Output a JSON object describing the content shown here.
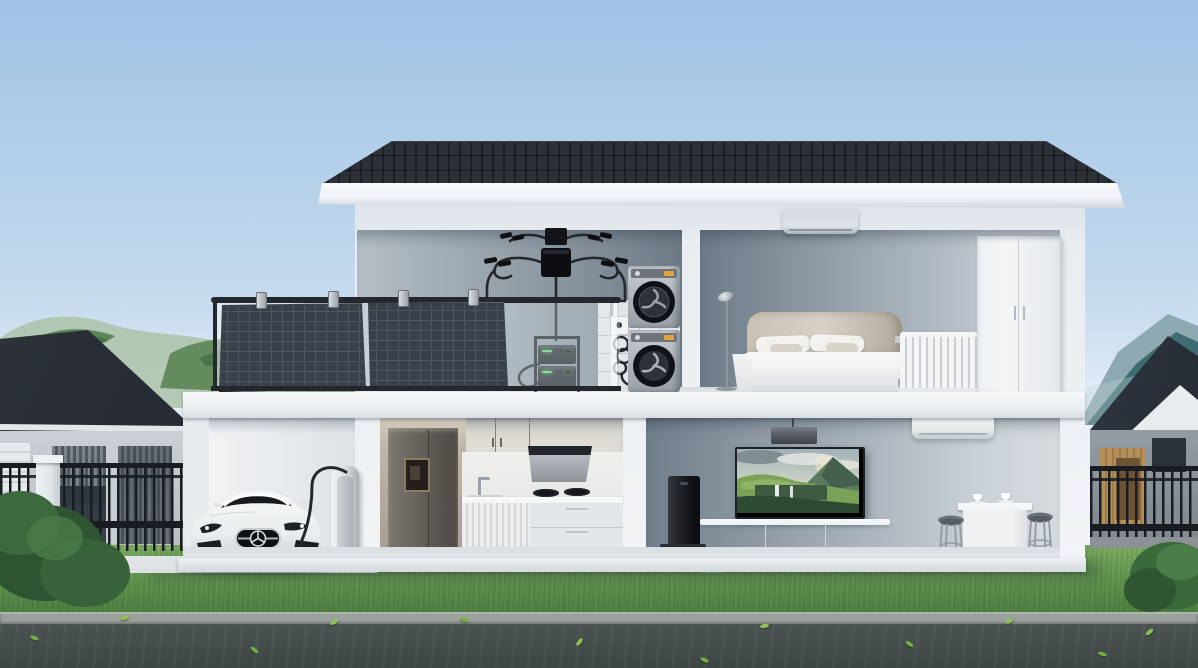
{
  "meta": {
    "type": "3d-architectural-render",
    "description": "Cutaway view of a two-storey smart home with balcony solar panels, micro-inverter, stacked battery storage, EV charging, and smart appliances; neighbouring houses, fences, lawn and road in front, mountains behind",
    "width": 1198,
    "height": 668
  },
  "colors": {
    "sky_top": "#9fc2e4",
    "sky_mid": "#c6dbee",
    "sky_low": "#e7eff7",
    "cloud": "#f6fafc",
    "roof": "#23262d",
    "fascia": "#eef1f5",
    "wall": "#e9edf1",
    "slab": "#edf0f3",
    "plinth": "#eef1f4",
    "laundry_l": "#b6bfc6",
    "laundry_r": "#6e7b87",
    "bed_l": "#6d7b88",
    "bed_r": "#c5cdd4",
    "liv_l": "#707e8b",
    "liv_r": "#cbd2d8",
    "tile": "#eef0f1",
    "floor": "#e1e5e9",
    "panel": "#394049",
    "panel_line": "#4d5560",
    "rail": "#24282d",
    "glass": "rgba(228,238,245,0.30)",
    "inverter": "#121418",
    "cable": "#24272b",
    "washer_hi": "#c6cbd0",
    "washer_lo": "#99a0a7",
    "washer_panel": "#6d747b",
    "door_black": "#0e1115",
    "door_inner": "#2d3237",
    "display_orange": "#e8a23c",
    "batt": "#1e2327",
    "batt_hi": "#3a4147",
    "led": "#5bd36e",
    "fridge": "#615c57",
    "fridge_hi": "#7d7771",
    "cab_upper": "#a8a29a",
    "cab_tall": "#bfb5a8",
    "hood_dark": "#22262a",
    "hood_body": "#b5bbc1",
    "splash": "#e9e9e7",
    "counter": "#f4f5f6",
    "cab_lower": "#e4e7e9",
    "car": "#eaedef",
    "car_shade": "#c2c8cd",
    "car_glass": "#171b20",
    "car_dark": "#1d2126",
    "charger": "#dfe3e6",
    "charger_dark": "#aab1b7",
    "tv_frame": "#1d2126",
    "console": "#eef1f3",
    "soundbar": "#34383d",
    "dock": "#17191d",
    "robot": "#282c31",
    "mat": "#86add0",
    "ac": "#dde2e7",
    "ac2": "#e8eced",
    "pend": "#565c63",
    "table": "#eff1f3",
    "stool": "#6b7379",
    "stool_leg": "#959ca2",
    "lamp": "#8f979e",
    "head": "#c9c1b4",
    "head_dark": "#b2aa9d",
    "pillow": "#f0efec",
    "cushion": "#d9d3c9",
    "duvet": "#f1f2f3",
    "bedbase": "#e9ebee",
    "radiator": "#f3f5f7",
    "rad_shade": "#c9cfd5",
    "wardrobe": "#f3f5f7",
    "ward_seam": "#c4cbd1",
    "lawn": "#649751",
    "lawn_light": "#7cab60",
    "lawn_dark": "#4a7a3e",
    "pad": "#dbdfe1",
    "curb": "#9ba19d",
    "road": "#4a5351",
    "road_dark": "#3d4644",
    "leaf": "#6fae3f",
    "fence": "#191d21",
    "pillar": "#e2e6e9",
    "base_conc": "#8b9194",
    "n_roof": "#272c34",
    "n_wall": "#c9cfd4",
    "n_wall2": "#949ca3",
    "n_win": "#2b323a",
    "slat": "#8d959c",
    "wood": "#b58f58",
    "wood_dark": "#6e5236",
    "hill_far": "#a9c0a5",
    "hill_near": "#55804f",
    "hill_dark": "#3e6a42",
    "mtn_far": "#8fa9b2",
    "mtn_near": "#3f6c72"
  },
  "scene": {
    "environment": {
      "sky": "clear blue sky with faint clouds near the horizon",
      "hills_left": "hazy green treeline behind the left neighbour house",
      "mountains_right": "teal mountain ridge behind the right neighbour house",
      "lawn": "green front lawn",
      "pad": "concrete driveway apron in front of the garage",
      "curb": "stone curb",
      "road": "asphalt road with scattered green leaves"
    },
    "neighbors": {
      "left_house": "single-storey neighbour house with dark hip roof, slatted windows and garage door",
      "right_house": "neighbour house with dark gable roof, timber-slat entry and dark door",
      "left_fence": "black metal picket fence with white masonry pillar",
      "right_fence": "black metal picket fence on concrete base",
      "bushes": "green shrubs at both lower corners"
    },
    "house": {
      "roof": "dark standing-seam flat-pitch roof with white fascia band",
      "structure": "white cutaway two-storey house showing interiors",
      "upper_floor": {
        "balcony": {
          "solar_panels": "two dark photovoltaic panels hung on the balcony railing",
          "railing": "glass balustrade with dark top and bottom rails",
          "micro_inverter": "two wall-mounted micro-inverter units with looped MC4 connector cabling",
          "battery": "stacked portable power station with green charge LEDs in a floor rack"
        },
        "laundry": {
          "washer_dryer": "stacked silver washer and dryer with round black doors and orange displays",
          "outlet": "wall outlet with coiled power cord",
          "tiled_wall": "white tiled wall section behind the appliances"
        },
        "bedroom": {
          "air_conditioner": "wall-mounted split air conditioner",
          "floor_lamp": "slim floor lamp",
          "bed": "double bed with beige fabric headboard, white pillows and duvet",
          "radiator": "white column radiator",
          "wardrobe": "tall white two-door wardrobe"
        }
      },
      "ground_floor": {
        "garage": {
          "car": "white Mercedes gullwing sports car parked facing outward",
          "ev_charger": "silver EV charging pedestal with looped charging cable"
        },
        "kitchen": {
          "fridge": "dark bronze refrigerator with water dispenser set in tall beige cabinetry",
          "upper_cabinets": "taupe upper cabinet doors",
          "range_hood": "angled dark-and-silver range hood",
          "cooktop": "two-burner gas cooktop",
          "sink": "counter sink with bar faucet",
          "lower_cabinets": "white fluted lower cabinets and drawer bank"
        },
        "living_room": {
          "pendant_light": "rectangular dark pendant light",
          "tv": "wall-mounted TV showing a green mountain landscape with waterfalls",
          "tv_console": "long white media console on low legs",
          "soundbar": "dark soundbar on the floor",
          "robot_vacuum": "robot vacuum parked by its black charging dock tower",
          "air_conditioner": "wall-mounted split air conditioner",
          "high_table": "white high table with two coffee cups",
          "stools": "two grey metal bar stools"
        }
      }
    }
  }
}
